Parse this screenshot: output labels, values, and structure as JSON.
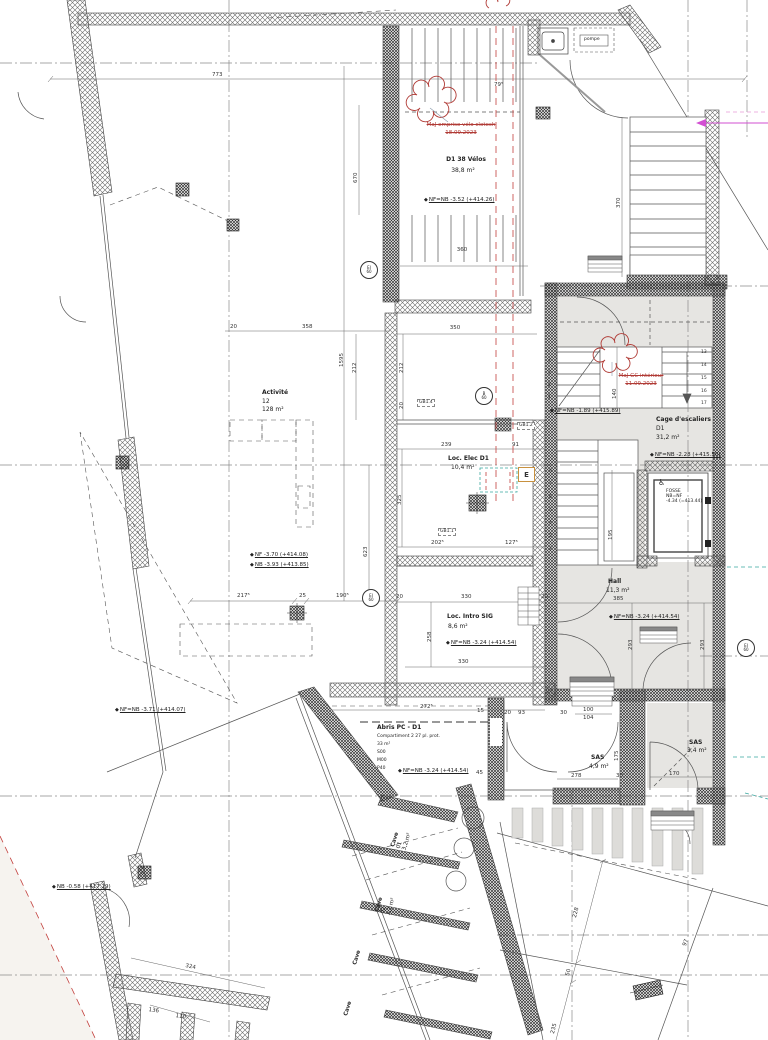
{
  "drawing": {
    "rooms": {
      "velos": {
        "title": "D1 38 Vélos",
        "area": "38,8 m²"
      },
      "activite": {
        "title": "Activité",
        "num": "12",
        "area": "128 m²"
      },
      "loc_elec": {
        "title": "Loc. Elec D1",
        "area": "10,4 m²"
      },
      "loc_intro": {
        "title": "Loc. Intro SIG",
        "area": "8,6 m²"
      },
      "cage": {
        "title": "Cage d'escaliers",
        "num": "D1",
        "area": "31,2 m²"
      },
      "hall": {
        "title": "Hall",
        "area": "11,3 m²"
      },
      "fosse": {
        "l1": "FOSSE",
        "l2": "NB=NF",
        "l3": "-4.34 (=413.44)"
      },
      "abris": {
        "title": "Abris PC - D1",
        "l2": "Compartiment 2 27 pl. prot.",
        "area": "33 m²",
        "l4": "S00",
        "l5": "M00",
        "l6": "P40"
      },
      "sas1": {
        "title": "SAS",
        "area": "4,9 m²"
      },
      "sas2": {
        "title": "SAS",
        "area": "3,4 m²"
      },
      "cave1": {
        "title": "Cave",
        "num": "01",
        "area": "3,2 m²"
      },
      "cave2": {
        "title": "Cave",
        "num": "02",
        "area": "3,2 m²"
      },
      "cave3": {
        "title": "Cave"
      },
      "cave4": {
        "title": "Cave"
      }
    },
    "levels": {
      "velos": "NF=NB -3.52 (+414.26)",
      "cage_top": "NF=NB -1.89 (+415.89)",
      "cage_bottom": "NF=NB -2.28 (+415.50)",
      "activite_nf": "NF -3.70 (+414.08)",
      "activite_nb": "NB -3.93 (+413.85)",
      "hall": "NF=NB -3.24 (+414.54)",
      "intro": "NF=NB -3.24 (+414.54)",
      "abris": "NF=NB -3.24 (+414.54)",
      "door": "NF=NB -3.71 (+414.07)",
      "exterior": "NB -0.58 (+417.19)"
    },
    "revisions": {
      "velo": {
        "l1": "MaJ emprise vélo clotech",
        "l2": "18.09.2023"
      },
      "gc": {
        "l1": "MaJ GC intérieur",
        "l2": "11.09.2023"
      }
    },
    "tags": {
      "pompe": "pompe",
      "elec": "E",
      "gb11": "GB1.1",
      "gb12": "GB1.2",
      "gb14": "GB1.4",
      "fire_b": {
        "top": "B",
        "bottom": "60"
      },
      "fire_ei": {
        "top": "EI",
        "bottom": "60"
      }
    },
    "icons": {
      "level": "◆",
      "wheelchair": "♿"
    },
    "dims": {
      "d773": "773",
      "d79": "79⁵",
      "d670": "670",
      "d360": "360",
      "d350": "350",
      "d20a": "20",
      "d358": "358",
      "d1595": "1595",
      "d212a": "212",
      "d212b": "212",
      "d20b": "20",
      "d239": "239",
      "d91": "91",
      "d325": "325",
      "d202": "202⁵",
      "d127": "127⁵",
      "d623": "623",
      "d217": "217⁵",
      "d25": "25",
      "d190": "190⁵",
      "d20c": "20",
      "d330a": "330",
      "d20d": "20",
      "d330b": "330",
      "d258": "258",
      "d385": "385",
      "d293a": "293",
      "d293b": "293",
      "d140": "140",
      "d195": "195",
      "d370": "370",
      "d272": "272⁵",
      "d15": "15",
      "d20e": "20",
      "d93": "93",
      "d45": "45",
      "d30a": "30",
      "d100": "100",
      "d104": "104",
      "d175": "175",
      "d278": "278",
      "d30b": "30",
      "d170": "170",
      "d228": "228",
      "d50": "50",
      "d235": "235",
      "d97": "97",
      "d324": "324",
      "d136": "136",
      "d110": "110"
    },
    "stairs": {
      "upper": [
        "4",
        "3",
        "2",
        "1"
      ],
      "mid": [
        "13",
        "14",
        "15",
        "16",
        "17"
      ],
      "lower": [
        "8",
        "7",
        "6",
        "5",
        "4",
        "3",
        "2"
      ]
    }
  }
}
